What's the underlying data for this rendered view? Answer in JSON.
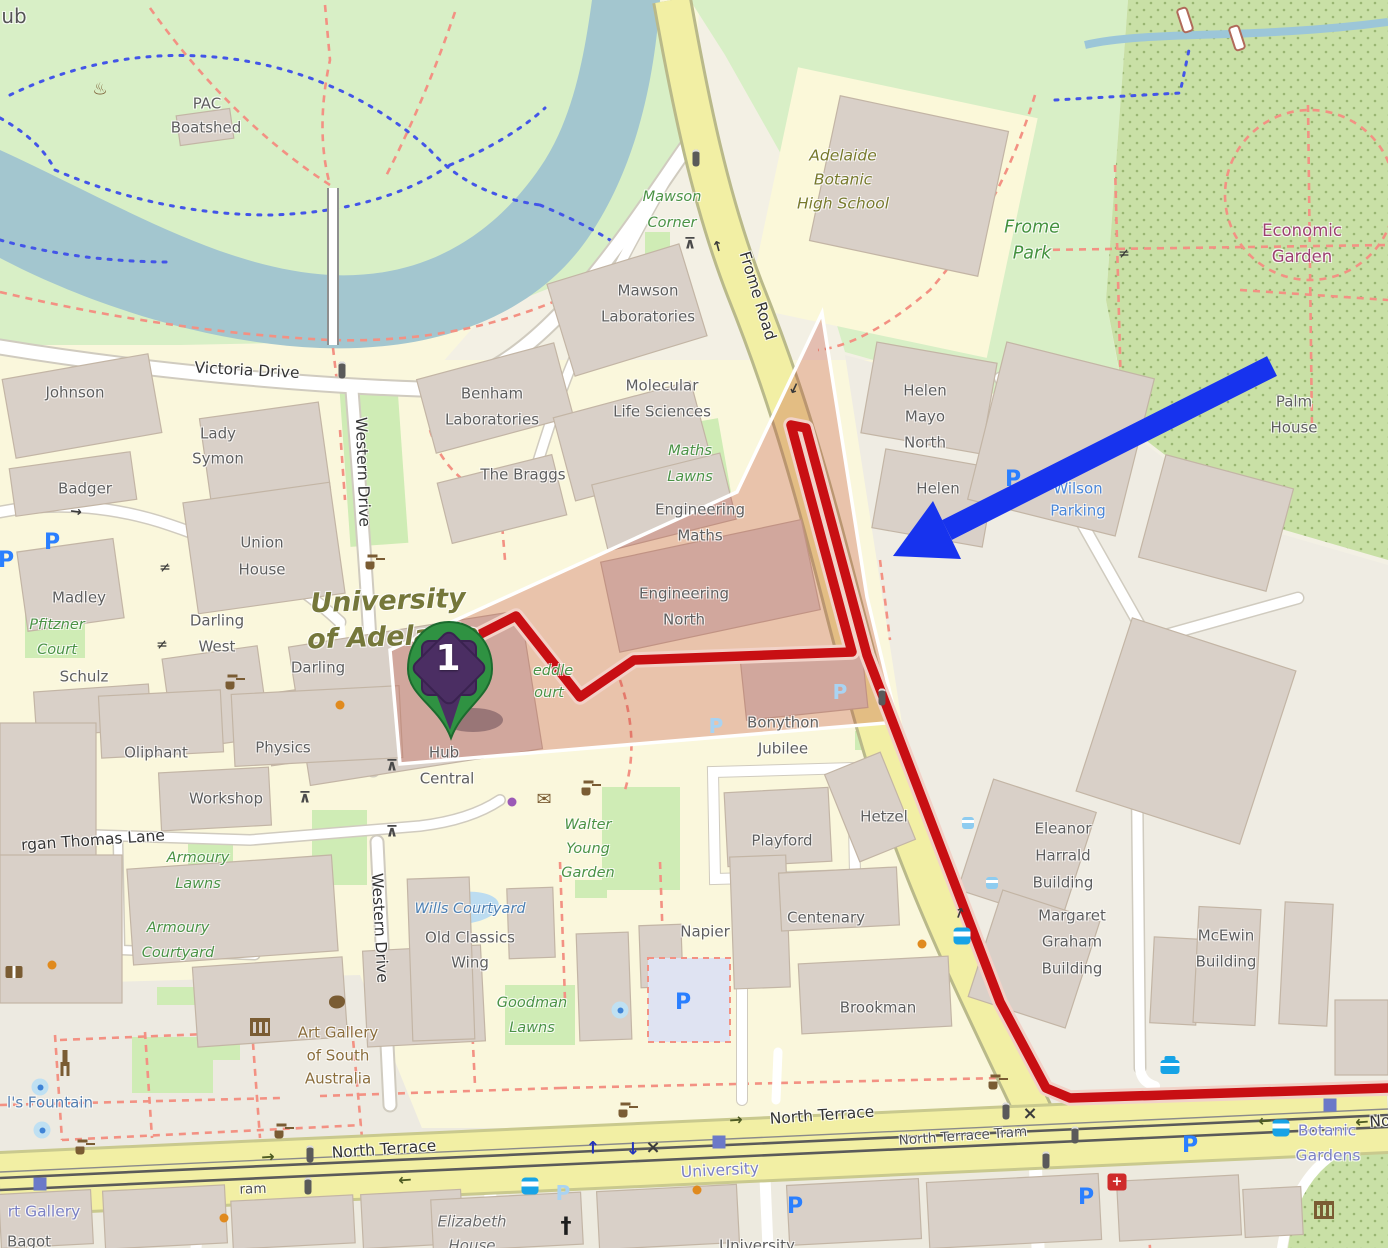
{
  "marker": {
    "label": "1"
  },
  "overlays": {
    "route_color": "#c80f13",
    "route_casing": "#f2d2c8",
    "route_points": "455,647 516,616 580,697 634,660 852,652 791,425 806,428 867,655 1000,1002 1046,1088 1070,1098 1388,1088",
    "highlight_polygon": "822,313 737,492 390,650 400,764 897,722 867,597",
    "highlight_fill": "rgba(190,60,45,0.28)",
    "arrow_color": "#1733ee",
    "arrow_shaft": {
      "x1": 1272,
      "y1": 366,
      "x2": 947,
      "y2": 530
    },
    "arrow_head": "893,556 933,501 961,559"
  },
  "labels": [
    {
      "t": "ub",
      "x": 14,
      "y": 16,
      "c": "nm"
    },
    {
      "t": "PAC",
      "x": 207,
      "y": 104,
      "c": "b"
    },
    {
      "t": "Boatshed",
      "x": 206,
      "y": 128,
      "c": "b"
    },
    {
      "t": "Victoria Drive",
      "x": 247,
      "y": 371,
      "c": "r",
      "r": 3
    },
    {
      "t": "Johnson",
      "x": 75,
      "y": 393,
      "c": "b"
    },
    {
      "t": "Lady",
      "x": 218,
      "y": 434,
      "c": "b"
    },
    {
      "t": "Symon",
      "x": 218,
      "y": 459,
      "c": "b"
    },
    {
      "t": "Badger",
      "x": 85,
      "y": 489,
      "c": "b"
    },
    {
      "t": "Union",
      "x": 262,
      "y": 543,
      "c": "b"
    },
    {
      "t": "House",
      "x": 262,
      "y": 570,
      "c": "b"
    },
    {
      "t": "Madley",
      "x": 79,
      "y": 598,
      "c": "b"
    },
    {
      "t": "Pfitzner",
      "x": 57,
      "y": 625,
      "c": "g"
    },
    {
      "t": "Court",
      "x": 57,
      "y": 650,
      "c": "g"
    },
    {
      "t": "Darling",
      "x": 217,
      "y": 621,
      "c": "b"
    },
    {
      "t": "West",
      "x": 217,
      "y": 647,
      "c": "b"
    },
    {
      "t": "Darling",
      "x": 318,
      "y": 668,
      "c": "b"
    },
    {
      "t": "Schulz",
      "x": 84,
      "y": 677,
      "c": "b"
    },
    {
      "t": "Western Drive",
      "x": 362,
      "y": 472,
      "c": "r",
      "r": 88
    },
    {
      "t": "Western Drive",
      "x": 379,
      "y": 928,
      "c": "r",
      "r": 87
    },
    {
      "t": "Mawson",
      "x": 648,
      "y": 291,
      "c": "b"
    },
    {
      "t": "Laboratories",
      "x": 648,
      "y": 317,
      "c": "b"
    },
    {
      "t": "Benham",
      "x": 492,
      "y": 394,
      "c": "b"
    },
    {
      "t": "Laboratories",
      "x": 492,
      "y": 420,
      "c": "b"
    },
    {
      "t": "Molecular",
      "x": 662,
      "y": 386,
      "c": "b"
    },
    {
      "t": "Life Sciences",
      "x": 662,
      "y": 412,
      "c": "b"
    },
    {
      "t": "The Braggs",
      "x": 523,
      "y": 475,
      "c": "b"
    },
    {
      "t": "Mawson",
      "x": 672,
      "y": 197,
      "c": "g"
    },
    {
      "t": "Corner",
      "x": 672,
      "y": 223,
      "c": "g"
    },
    {
      "t": "Frome Road",
      "x": 757,
      "y": 296,
      "c": "r",
      "r": 73
    },
    {
      "t": "Adelaide",
      "x": 843,
      "y": 156,
      "c": "sc"
    },
    {
      "t": "Botanic",
      "x": 843,
      "y": 180,
      "c": "sc"
    },
    {
      "t": "High School",
      "x": 843,
      "y": 204,
      "c": "sc"
    },
    {
      "t": "Frome",
      "x": 1032,
      "y": 228,
      "c": "gl"
    },
    {
      "t": "Park",
      "x": 1032,
      "y": 254,
      "c": "gl"
    },
    {
      "t": "Economic",
      "x": 1302,
      "y": 231,
      "c": "pu"
    },
    {
      "t": "Garden",
      "x": 1302,
      "y": 257,
      "c": "pu"
    },
    {
      "t": "Palm",
      "x": 1294,
      "y": 402,
      "c": "b"
    },
    {
      "t": "House",
      "x": 1294,
      "y": 428,
      "c": "b"
    },
    {
      "t": "Maths",
      "x": 690,
      "y": 451,
      "c": "g"
    },
    {
      "t": "Lawns",
      "x": 690,
      "y": 477,
      "c": "g"
    },
    {
      "t": "Engineering",
      "x": 700,
      "y": 510,
      "c": "b"
    },
    {
      "t": "Maths",
      "x": 700,
      "y": 536,
      "c": "b"
    },
    {
      "t": "Engineering",
      "x": 684,
      "y": 594,
      "c": "b"
    },
    {
      "t": "North",
      "x": 684,
      "y": 620,
      "c": "b"
    },
    {
      "t": "Helen",
      "x": 925,
      "y": 391,
      "c": "b"
    },
    {
      "t": "Mayo",
      "x": 925,
      "y": 417,
      "c": "b"
    },
    {
      "t": "North",
      "x": 925,
      "y": 443,
      "c": "b"
    },
    {
      "t": "Helen",
      "x": 938,
      "y": 489,
      "c": "b"
    },
    {
      "t": "Wilson",
      "x": 1078,
      "y": 489,
      "c": "wi"
    },
    {
      "t": "Parking",
      "x": 1078,
      "y": 511,
      "c": "wi"
    },
    {
      "t": "University",
      "x": 388,
      "y": 601,
      "c": "ol",
      "r": -2
    },
    {
      "t": "of Adelaide",
      "x": 393,
      "y": 637,
      "c": "ol",
      "r": -2
    },
    {
      "t": "eddle",
      "x": 553,
      "y": 671,
      "c": "g"
    },
    {
      "t": "ourt",
      "x": 549,
      "y": 693,
      "c": "g"
    },
    {
      "t": "Hub",
      "x": 444,
      "y": 753,
      "c": "b"
    },
    {
      "t": "Central",
      "x": 447,
      "y": 779,
      "c": "b"
    },
    {
      "t": "Bonython",
      "x": 783,
      "y": 723,
      "c": "b"
    },
    {
      "t": "Jubilee",
      "x": 783,
      "y": 749,
      "c": "b"
    },
    {
      "t": "Playford",
      "x": 782,
      "y": 841,
      "c": "b"
    },
    {
      "t": "Hetzel",
      "x": 884,
      "y": 817,
      "c": "b"
    },
    {
      "t": "Oliphant",
      "x": 156,
      "y": 753,
      "c": "b"
    },
    {
      "t": "Physics",
      "x": 283,
      "y": 748,
      "c": "b"
    },
    {
      "t": "Workshop",
      "x": 226,
      "y": 799,
      "c": "b"
    },
    {
      "t": "rgan Thomas Lane",
      "x": 93,
      "y": 841,
      "c": "r",
      "r": -4
    },
    {
      "t": "Armoury",
      "x": 198,
      "y": 858,
      "c": "g"
    },
    {
      "t": "Lawns",
      "x": 198,
      "y": 884,
      "c": "g"
    },
    {
      "t": "Armoury",
      "x": 178,
      "y": 928,
      "c": "g"
    },
    {
      "t": "Courtyard",
      "x": 178,
      "y": 953,
      "c": "g"
    },
    {
      "t": "Walter",
      "x": 588,
      "y": 825,
      "c": "g"
    },
    {
      "t": "Young",
      "x": 588,
      "y": 849,
      "c": "g"
    },
    {
      "t": "Garden",
      "x": 588,
      "y": 873,
      "c": "g"
    },
    {
      "t": "Wills Courtyard",
      "x": 470,
      "y": 909,
      "c": "bi"
    },
    {
      "t": "Old Classics",
      "x": 470,
      "y": 938,
      "c": "b"
    },
    {
      "t": "Wing",
      "x": 470,
      "y": 963,
      "c": "b"
    },
    {
      "t": "Goodman",
      "x": 532,
      "y": 1003,
      "c": "g"
    },
    {
      "t": "Lawns",
      "x": 532,
      "y": 1028,
      "c": "g"
    },
    {
      "t": "Napier",
      "x": 705,
      "y": 932,
      "c": "b"
    },
    {
      "t": "Centenary",
      "x": 826,
      "y": 918,
      "c": "b"
    },
    {
      "t": "Brookman",
      "x": 878,
      "y": 1008,
      "c": "b"
    },
    {
      "t": "Eleanor",
      "x": 1063,
      "y": 829,
      "c": "b"
    },
    {
      "t": "Harrald",
      "x": 1063,
      "y": 856,
      "c": "b"
    },
    {
      "t": "Building",
      "x": 1063,
      "y": 883,
      "c": "b"
    },
    {
      "t": "Margaret",
      "x": 1072,
      "y": 916,
      "c": "b"
    },
    {
      "t": "Graham",
      "x": 1072,
      "y": 942,
      "c": "b"
    },
    {
      "t": "Building",
      "x": 1072,
      "y": 969,
      "c": "b"
    },
    {
      "t": "McEwin",
      "x": 1226,
      "y": 936,
      "c": "b"
    },
    {
      "t": "Building",
      "x": 1226,
      "y": 962,
      "c": "b"
    },
    {
      "t": "Art Gallery",
      "x": 338,
      "y": 1033,
      "c": "br"
    },
    {
      "t": "of South",
      "x": 338,
      "y": 1056,
      "c": "br"
    },
    {
      "t": "Australia",
      "x": 338,
      "y": 1079,
      "c": "br"
    },
    {
      "t": "l's Fountain",
      "x": 50,
      "y": 1103,
      "c": "fo"
    },
    {
      "t": "North Terrace",
      "x": 384,
      "y": 1150,
      "c": "r",
      "r": -4
    },
    {
      "t": "North Terrace",
      "x": 822,
      "y": 1116,
      "c": "r",
      "r": -4
    },
    {
      "t": "North Terrace Tram",
      "x": 963,
      "y": 1137,
      "c": "rs",
      "r": -4
    },
    {
      "t": "No",
      "x": 1380,
      "y": 1122,
      "c": "r",
      "r": -4
    },
    {
      "t": "ram",
      "x": 253,
      "y": 1190,
      "c": "rs",
      "r": -2
    },
    {
      "t": "University",
      "x": 720,
      "y": 1171,
      "c": "tr",
      "r": -3
    },
    {
      "t": "Botanic",
      "x": 1327,
      "y": 1131,
      "c": "tr"
    },
    {
      "t": "Gardens",
      "x": 1328,
      "y": 1156,
      "c": "tr"
    },
    {
      "t": "rt Gallery",
      "x": 44,
      "y": 1212,
      "c": "tr"
    },
    {
      "t": "Elizabeth",
      "x": 472,
      "y": 1222,
      "c": "gi"
    },
    {
      "t": "House",
      "x": 472,
      "y": 1246,
      "c": "gi"
    },
    {
      "t": "Bagot",
      "x": 29,
      "y": 1242,
      "c": "b"
    },
    {
      "t": "University",
      "x": 757,
      "y": 1246,
      "c": "b"
    }
  ],
  "icons": [
    {
      "n": "p",
      "x": 52,
      "y": 543,
      "g": "P"
    },
    {
      "n": "p",
      "x": 6,
      "y": 561,
      "g": "P"
    },
    {
      "n": "p",
      "x": 1013,
      "y": 480,
      "g": "P"
    },
    {
      "n": "p",
      "x": 683,
      "y": 1003,
      "g": "P"
    },
    {
      "n": "p",
      "x": 795,
      "y": 1207,
      "g": "P"
    },
    {
      "n": "p",
      "x": 1190,
      "y": 1146,
      "g": "P"
    },
    {
      "n": "p",
      "x": 1086,
      "y": 1198,
      "g": "P"
    },
    {
      "n": "pl",
      "x": 563,
      "y": 1193,
      "g": "P"
    },
    {
      "n": "pl",
      "x": 840,
      "y": 692,
      "g": "P"
    },
    {
      "n": "pl",
      "x": 716,
      "y": 726,
      "g": "P"
    },
    {
      "n": "bus",
      "x": 962,
      "y": 936
    },
    {
      "n": "bus",
      "x": 530,
      "y": 1186
    },
    {
      "n": "bus",
      "x": 1281,
      "y": 1128
    },
    {
      "n": "busstop",
      "x": 968,
      "y": 823
    },
    {
      "n": "busstop",
      "x": 992,
      "y": 883
    },
    {
      "n": "taxi",
      "x": 1170,
      "y": 1067
    },
    {
      "n": "hosp",
      "x": 1117,
      "y": 1182,
      "g": "+"
    },
    {
      "n": "mus",
      "x": 260,
      "y": 1027
    },
    {
      "n": "mus",
      "x": 1324,
      "y": 1210
    },
    {
      "n": "church",
      "x": 566,
      "y": 1227,
      "g": "†"
    },
    {
      "n": "book",
      "x": 14,
      "y": 972
    },
    {
      "n": "statue",
      "x": 65,
      "y": 1058
    },
    {
      "n": "palette",
      "x": 337,
      "y": 1002
    },
    {
      "n": "bbq",
      "x": 100,
      "y": 90,
      "g": "♨"
    },
    {
      "n": "mail",
      "x": 544,
      "y": 800,
      "g": "✉"
    },
    {
      "n": "fnt",
      "x": 372,
      "y": 562
    },
    {
      "n": "fnt",
      "x": 232,
      "y": 682
    },
    {
      "n": "fnt",
      "x": 588,
      "y": 788
    },
    {
      "n": "fnt",
      "x": 82,
      "y": 1147
    },
    {
      "n": "fnt",
      "x": 281,
      "y": 1131
    },
    {
      "n": "fnt",
      "x": 625,
      "y": 1110
    },
    {
      "n": "fnt",
      "x": 995,
      "y": 1082
    },
    {
      "n": "fntb",
      "x": 40,
      "y": 1087
    },
    {
      "n": "fntb",
      "x": 42,
      "y": 1130
    },
    {
      "n": "fntb",
      "x": 620,
      "y": 1010
    },
    {
      "n": "sig",
      "x": 342,
      "y": 370
    },
    {
      "n": "sig",
      "x": 696,
      "y": 158
    },
    {
      "n": "sig",
      "x": 882,
      "y": 697
    },
    {
      "n": "sig",
      "x": 310,
      "y": 1154
    },
    {
      "n": "sig",
      "x": 308,
      "y": 1186
    },
    {
      "n": "sig",
      "x": 1006,
      "y": 1111
    },
    {
      "n": "sig",
      "x": 1046,
      "y": 1160
    },
    {
      "n": "sig",
      "x": 1075,
      "y": 1135
    },
    {
      "n": "x",
      "x": 653,
      "y": 1148,
      "g": "×"
    },
    {
      "n": "x",
      "x": 1030,
      "y": 1114,
      "g": "×"
    },
    {
      "n": "gate",
      "x": 165,
      "y": 568,
      "g": "≠"
    },
    {
      "n": "gate",
      "x": 162,
      "y": 645,
      "g": "≠"
    },
    {
      "n": "gate",
      "x": 1124,
      "y": 254,
      "g": "≠"
    },
    {
      "n": "pic",
      "x": 690,
      "y": 244,
      "g": "⊼"
    },
    {
      "n": "pic",
      "x": 305,
      "y": 798,
      "g": "⊼"
    },
    {
      "n": "pic",
      "x": 392,
      "y": 766,
      "g": "⊼"
    },
    {
      "n": "pic",
      "x": 392,
      "y": 832,
      "g": "⊼"
    },
    {
      "n": "ar",
      "x": 268,
      "y": 1157,
      "g": "→",
      "r": -4
    },
    {
      "n": "ar",
      "x": 736,
      "y": 1120,
      "g": "→",
      "r": -4
    },
    {
      "n": "ar",
      "x": 405,
      "y": 1180,
      "g": "←",
      "r": -4
    },
    {
      "n": "ar",
      "x": 1265,
      "y": 1121,
      "g": "←",
      "r": -4
    },
    {
      "n": "ar",
      "x": 1362,
      "y": 1122,
      "g": "←",
      "r": -4
    },
    {
      "n": "arb",
      "x": 593,
      "y": 1149,
      "g": "↑"
    },
    {
      "n": "arb",
      "x": 633,
      "y": 1150,
      "g": "↓"
    },
    {
      "n": "ard",
      "x": 718,
      "y": 246,
      "g": "→",
      "r": -105
    },
    {
      "n": "ard",
      "x": 794,
      "y": 388,
      "g": "→",
      "r": 115
    },
    {
      "n": "ard",
      "x": 960,
      "y": 913,
      "g": "→",
      "r": -70
    },
    {
      "n": "ard",
      "x": 76,
      "y": 512,
      "g": "→",
      "r": 8
    },
    {
      "n": "tsq",
      "x": 719,
      "y": 1142
    },
    {
      "n": "tsq",
      "x": 1330,
      "y": 1105
    },
    {
      "n": "tsq",
      "x": 40,
      "y": 1184
    },
    {
      "n": "doto",
      "x": 340,
      "y": 705
    },
    {
      "n": "doto",
      "x": 922,
      "y": 944
    },
    {
      "n": "doto",
      "x": 697,
      "y": 1190
    },
    {
      "n": "doto",
      "x": 52,
      "y": 965
    },
    {
      "n": "doto",
      "x": 224,
      "y": 1218
    },
    {
      "n": "dotp",
      "x": 512,
      "y": 802
    }
  ]
}
